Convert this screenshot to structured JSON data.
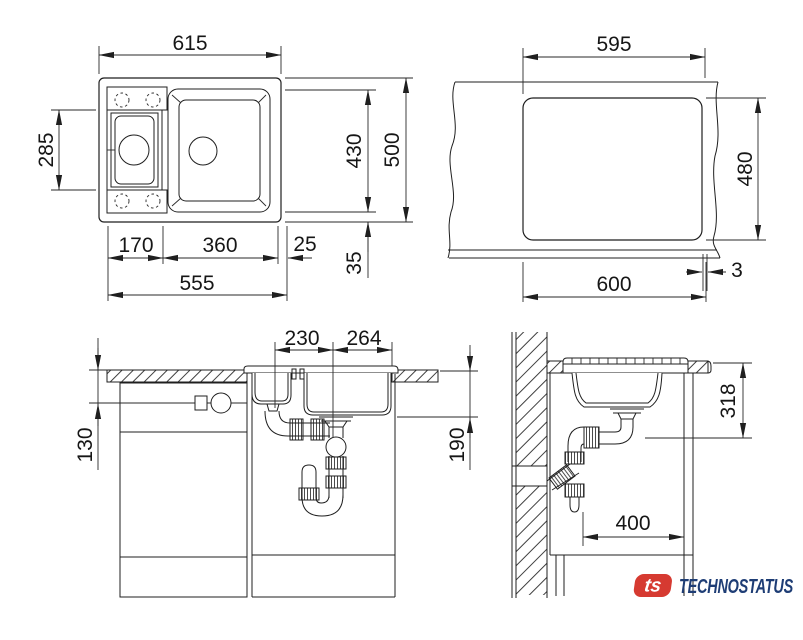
{
  "page": {
    "background": "#ffffff",
    "line_color": "#1f1f1f"
  },
  "views": {
    "top": {
      "label": "sink top view",
      "dims": {
        "overall_width": "615",
        "bowl_section_height": "285",
        "basin_zone_height": "430",
        "overall_depth": "500",
        "small_bowl_width": "170",
        "main_bowl_width": "360",
        "side_gap": "25",
        "edge_margin": "35",
        "bowls_span": "555"
      }
    },
    "cutout": {
      "label": "countertop cutout view",
      "dims": {
        "cutout_width": "595",
        "cutout_depth": "480",
        "base_width": "600",
        "edge_gap": "3"
      }
    },
    "front": {
      "label": "front section view",
      "dims": {
        "small_drain_offset": "230",
        "main_drain_offset": "264",
        "connection_height": "130",
        "bowl_depth": "190"
      }
    },
    "side": {
      "label": "side section view",
      "dims": {
        "outlet_height": "318",
        "install_depth": "400"
      }
    }
  },
  "logo": {
    "monogram": "ts",
    "brand": "TECHNOSTATUS",
    "red": "#d63a31",
    "navy": "#1e3d75"
  }
}
